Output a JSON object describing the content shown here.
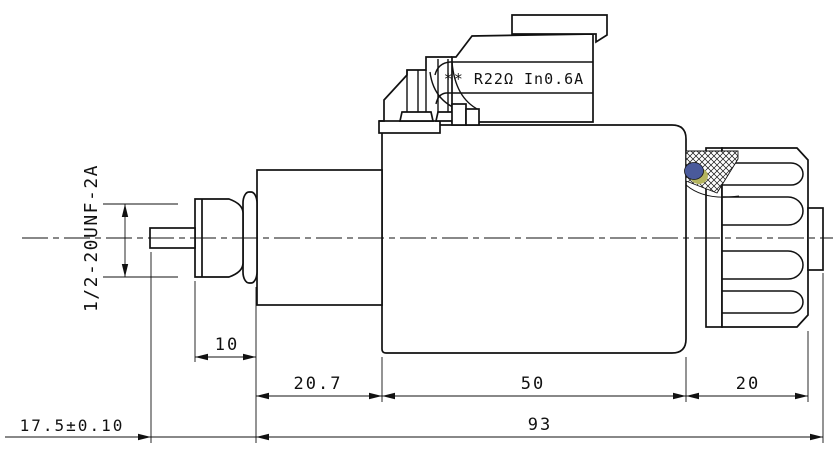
{
  "labels": {
    "coil_spec": "** R22Ω In0.6A",
    "thread": "1/2-20UNF-2A"
  },
  "dimensions": {
    "nut_length": "10",
    "tube_length": "20.7",
    "coil_length": "50",
    "knob_length": "20",
    "overall_length": "93",
    "pin_protrusion": "17.5±0.10"
  },
  "colors": {
    "line": "#111111",
    "seal_blue": "#4a5a9b",
    "seal_yellow": "#b5b55f",
    "background": "#ffffff"
  }
}
